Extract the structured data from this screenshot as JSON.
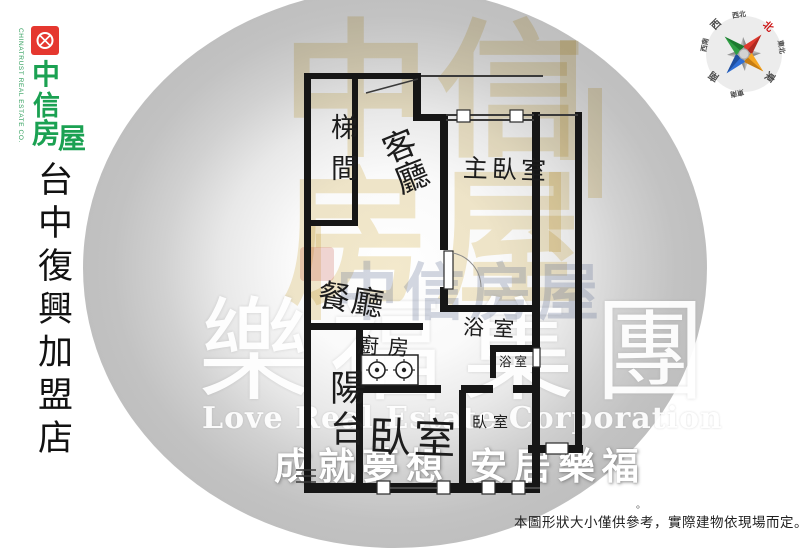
{
  "logo": {
    "brand_chars": [
      "中",
      "信",
      "房",
      "屋"
    ],
    "brand_name": "中信房屋",
    "subtext": "CHINATRUST REAL ESTATE CO.",
    "square_color": "#e5372f",
    "text_color": "#1ba152"
  },
  "store": {
    "name": "台中復興加盟店"
  },
  "compass": {
    "labels": [
      {
        "text": "西北"
      },
      {
        "text": "北",
        "color": "#cc1111"
      },
      {
        "text": "東北"
      },
      {
        "text": "東"
      },
      {
        "text": "東南"
      },
      {
        "text": "南"
      },
      {
        "text": "西南"
      },
      {
        "text": "西"
      }
    ],
    "point_colors": {
      "north": "#e0392e",
      "east": "#f5a623",
      "south": "#2f6fd6",
      "west": "#2f9e44"
    }
  },
  "floorplan": {
    "rooms": [
      {
        "id": "stairwell",
        "label": "梯間"
      },
      {
        "id": "living-room",
        "label": "客廳"
      },
      {
        "id": "master-bedroom",
        "label": "主臥室"
      },
      {
        "id": "dining-room",
        "label": "餐廳"
      },
      {
        "id": "kitchen",
        "label": "廚房"
      },
      {
        "id": "balcony",
        "label": "陽台"
      },
      {
        "id": "bathroom-main",
        "label": "浴室"
      },
      {
        "id": "bathroom-small",
        "label": "浴室"
      },
      {
        "id": "bedroom-large",
        "label": "臥室"
      },
      {
        "id": "bedroom-small",
        "label": "臥室"
      }
    ]
  },
  "watermarks": {
    "agency_large": "中信房屋",
    "agency_mid": "中信房屋",
    "group_name": "樂福集團",
    "group_name_en": "Love Real Estate Corporation",
    "slogan": "成就夢想 安居樂福"
  },
  "disclaimer": "本圖形狀大小僅供參考，實際建物依現場而定。",
  "stray_mark": "。",
  "icons": {
    "stove": "two-burner-stove",
    "compass": "eight-point-compass-rose",
    "logo_emblem": "knot-emblem"
  }
}
